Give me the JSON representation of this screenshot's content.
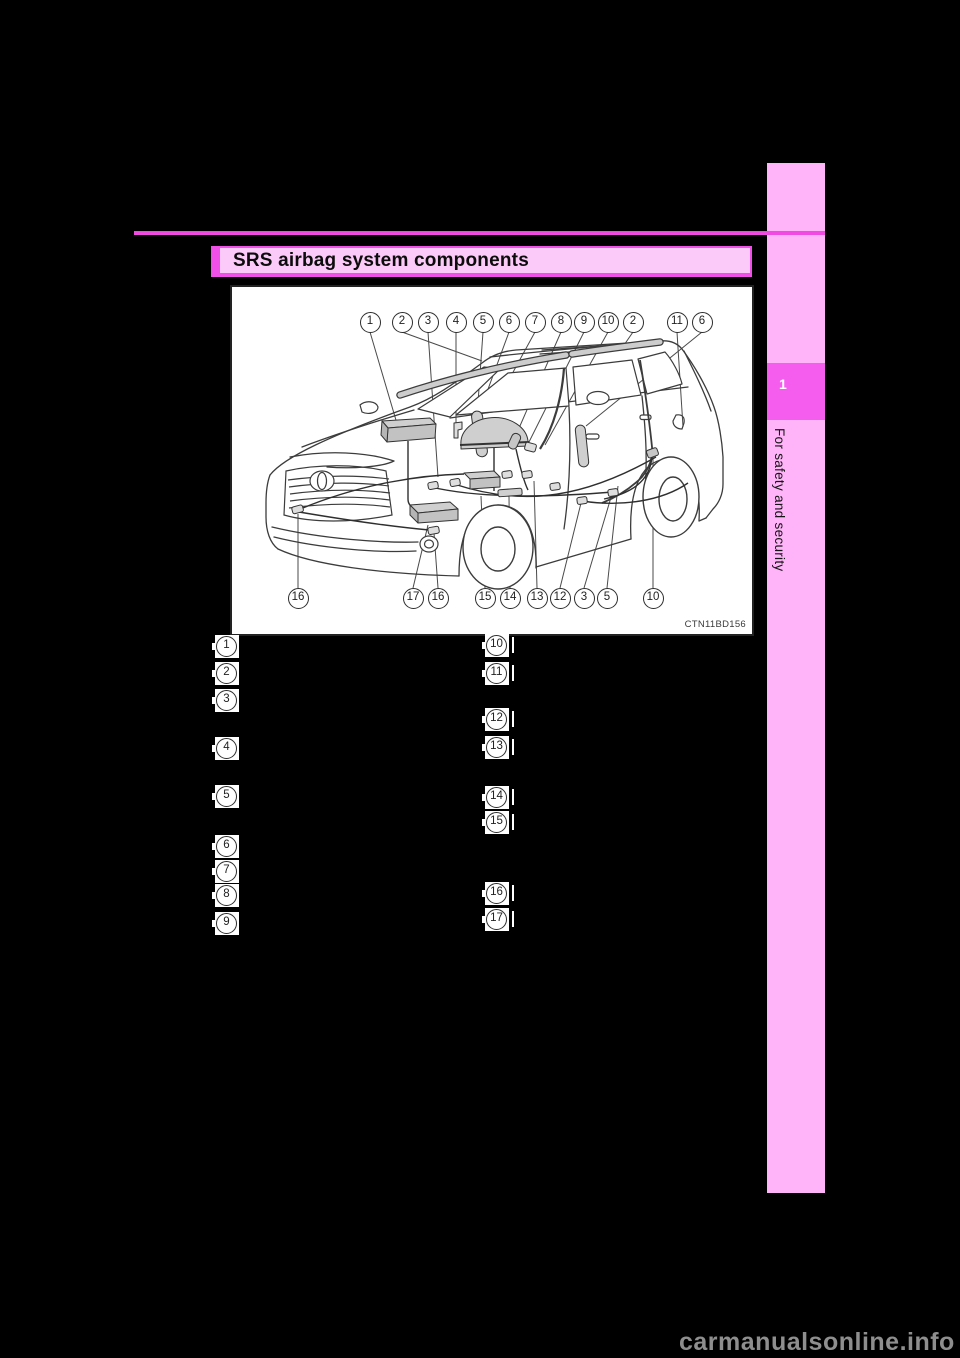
{
  "header": {
    "title": "SRS airbag system components"
  },
  "sidebar": {
    "chapter_number": "1",
    "chapter_title": "For safety and security"
  },
  "figure": {
    "code": "CTN11BD156",
    "top_callouts": [
      "1",
      "2",
      "3",
      "4",
      "5",
      "6",
      "7",
      "8",
      "9",
      "10",
      "2",
      "11",
      "6"
    ],
    "bottom_callouts": [
      "16",
      "17",
      "16",
      "15",
      "14",
      "13",
      "12",
      "3",
      "5",
      "10"
    ]
  },
  "legend": {
    "left_items": [
      "1",
      "2",
      "3",
      "4",
      "5",
      "6",
      "7",
      "8",
      "9"
    ],
    "right_items": [
      "10",
      "11",
      "12",
      "13",
      "14",
      "15",
      "16",
      "17"
    ]
  },
  "watermark": {
    "text": "carmanualsonline.info"
  },
  "colors": {
    "page_background": "#000000",
    "pink_light": "#ffb3f8",
    "pink_banner": "#fccaf8",
    "magenta_accent": "#f050e8",
    "magenta_rule": "#f04ae2",
    "chapter_box": "#f55def",
    "watermark_gray": "#8e8e8e"
  }
}
